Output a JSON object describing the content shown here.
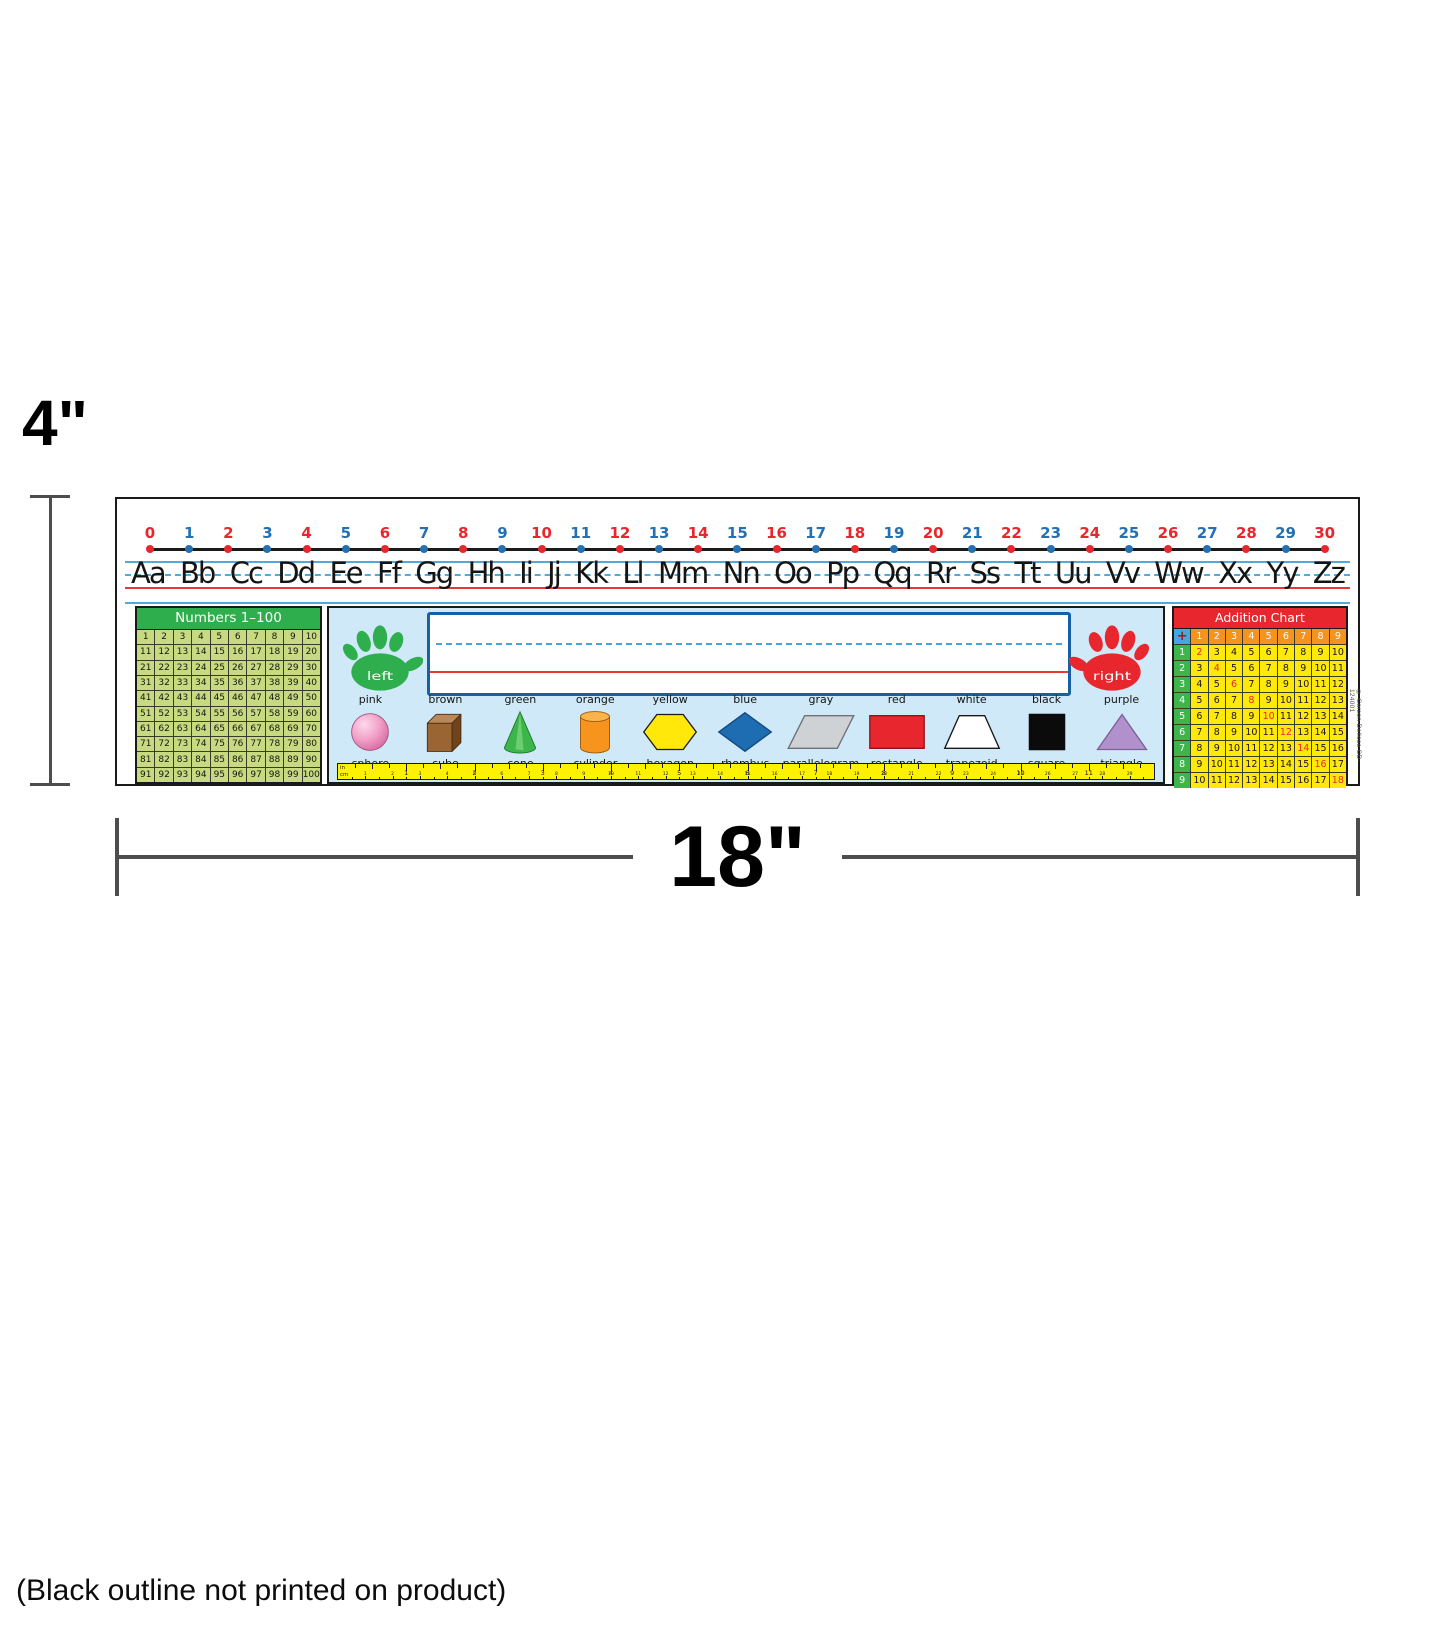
{
  "dimension_annotations": {
    "height_label": "4\"",
    "width_label": "18\""
  },
  "footnote": "(Black outline not printed on product)",
  "copyright": "© Carson-Dellosa CD-124001",
  "colors": {
    "number_even_red": "#e8262d",
    "number_odd_blue": "#2470b3",
    "guide_blue": "#55a9d9",
    "guide_red": "#e53935",
    "panel_bg_blue": "#cfe9f8",
    "numbers_grid_green": "#c8da80",
    "numbers_header_green": "#2fae4e",
    "addition_header_red": "#e8262d",
    "addition_col_orange": "#f6921e",
    "addition_row_green": "#3cb54a",
    "addition_body_yellow": "#ffe90a",
    "ruler_yellow": "#fff200"
  },
  "number_line": {
    "values": [
      0,
      1,
      2,
      3,
      4,
      5,
      6,
      7,
      8,
      9,
      10,
      11,
      12,
      13,
      14,
      15,
      16,
      17,
      18,
      19,
      20,
      21,
      22,
      23,
      24,
      25,
      26,
      27,
      28,
      29,
      30
    ]
  },
  "alphabet": {
    "pairs": [
      "Aa",
      "Bb",
      "Cc",
      "Dd",
      "Ee",
      "Ff",
      "Gg",
      "Hh",
      "Ii",
      "Jj",
      "Kk",
      "Ll",
      "Mm",
      "Nn",
      "Oo",
      "Pp",
      "Qq",
      "Rr",
      "Ss",
      "Tt",
      "Uu",
      "Vv",
      "Ww",
      "Xx",
      "Yy",
      "Zz"
    ]
  },
  "numbers_chart": {
    "title": "Numbers 1–100",
    "rows": [
      [
        1,
        2,
        3,
        4,
        5,
        6,
        7,
        8,
        9,
        10
      ],
      [
        11,
        12,
        13,
        14,
        15,
        16,
        17,
        18,
        19,
        20
      ],
      [
        21,
        22,
        23,
        24,
        25,
        26,
        27,
        28,
        29,
        30
      ],
      [
        31,
        32,
        33,
        34,
        35,
        36,
        37,
        38,
        39,
        40
      ],
      [
        41,
        42,
        43,
        44,
        45,
        46,
        47,
        48,
        49,
        50
      ],
      [
        51,
        52,
        53,
        54,
        55,
        56,
        57,
        58,
        59,
        60
      ],
      [
        61,
        62,
        63,
        64,
        65,
        66,
        67,
        68,
        69,
        70
      ],
      [
        71,
        72,
        73,
        74,
        75,
        76,
        77,
        78,
        79,
        80
      ],
      [
        81,
        82,
        83,
        84,
        85,
        86,
        87,
        88,
        89,
        90
      ],
      [
        91,
        92,
        93,
        94,
        95,
        96,
        97,
        98,
        99,
        100
      ]
    ]
  },
  "name_area": {
    "left_hand_label": "left",
    "right_hand_label": "right"
  },
  "shapes": {
    "items": [
      {
        "color_name": "pink",
        "shape_name": "sphere",
        "fill": "#f2a0c8"
      },
      {
        "color_name": "brown",
        "shape_name": "cube",
        "fill": "#9a6433"
      },
      {
        "color_name": "green",
        "shape_name": "cone",
        "fill": "#3cb54a"
      },
      {
        "color_name": "orange",
        "shape_name": "cylinder",
        "fill": "#f7941d"
      },
      {
        "color_name": "yellow",
        "shape_name": "hexagon",
        "fill": "#ffe80a"
      },
      {
        "color_name": "blue",
        "shape_name": "rhombus",
        "fill": "#1e6db2"
      },
      {
        "color_name": "gray",
        "shape_name": "parallelogram",
        "fill": "#cfd2d4"
      },
      {
        "color_name": "red",
        "shape_name": "rectangle",
        "fill": "#e8262d"
      },
      {
        "color_name": "white",
        "shape_name": "trapezoid",
        "fill": "#ffffff"
      },
      {
        "color_name": "black",
        "shape_name": "square",
        "fill": "#0b0b0b"
      },
      {
        "color_name": "purple",
        "shape_name": "triangle",
        "fill": "#b191cc"
      }
    ]
  },
  "ruler": {
    "inch_label": "in",
    "cm_label": "cm",
    "inch_numbers": [
      1,
      2,
      3,
      4,
      5,
      6,
      7,
      8,
      9,
      10,
      11
    ],
    "cm_numbers": [
      1,
      2,
      3,
      4,
      5,
      6,
      7,
      8,
      9,
      10,
      11,
      12,
      13,
      14,
      15,
      16,
      17,
      18,
      19,
      20,
      21,
      22,
      23,
      24,
      25,
      26,
      27,
      28,
      29,
      30
    ]
  },
  "addition_chart": {
    "title": "Addition Chart",
    "operator": "+",
    "col_headers": [
      1,
      2,
      3,
      4,
      5,
      6,
      7,
      8,
      9
    ],
    "row_headers": [
      1,
      2,
      3,
      4,
      5,
      6,
      7,
      8,
      9
    ],
    "rows": [
      [
        2,
        3,
        4,
        5,
        6,
        7,
        8,
        9,
        10
      ],
      [
        3,
        4,
        5,
        6,
        7,
        8,
        9,
        10,
        11
      ],
      [
        4,
        5,
        6,
        7,
        8,
        9,
        10,
        11,
        12
      ],
      [
        5,
        6,
        7,
        8,
        9,
        10,
        11,
        12,
        13
      ],
      [
        6,
        7,
        8,
        9,
        10,
        11,
        12,
        13,
        14
      ],
      [
        7,
        8,
        9,
        10,
        11,
        12,
        13,
        14,
        15
      ],
      [
        8,
        9,
        10,
        11,
        12,
        13,
        14,
        15,
        16
      ],
      [
        9,
        10,
        11,
        12,
        13,
        14,
        15,
        16,
        17
      ],
      [
        10,
        11,
        12,
        13,
        14,
        15,
        16,
        17,
        18
      ]
    ]
  }
}
